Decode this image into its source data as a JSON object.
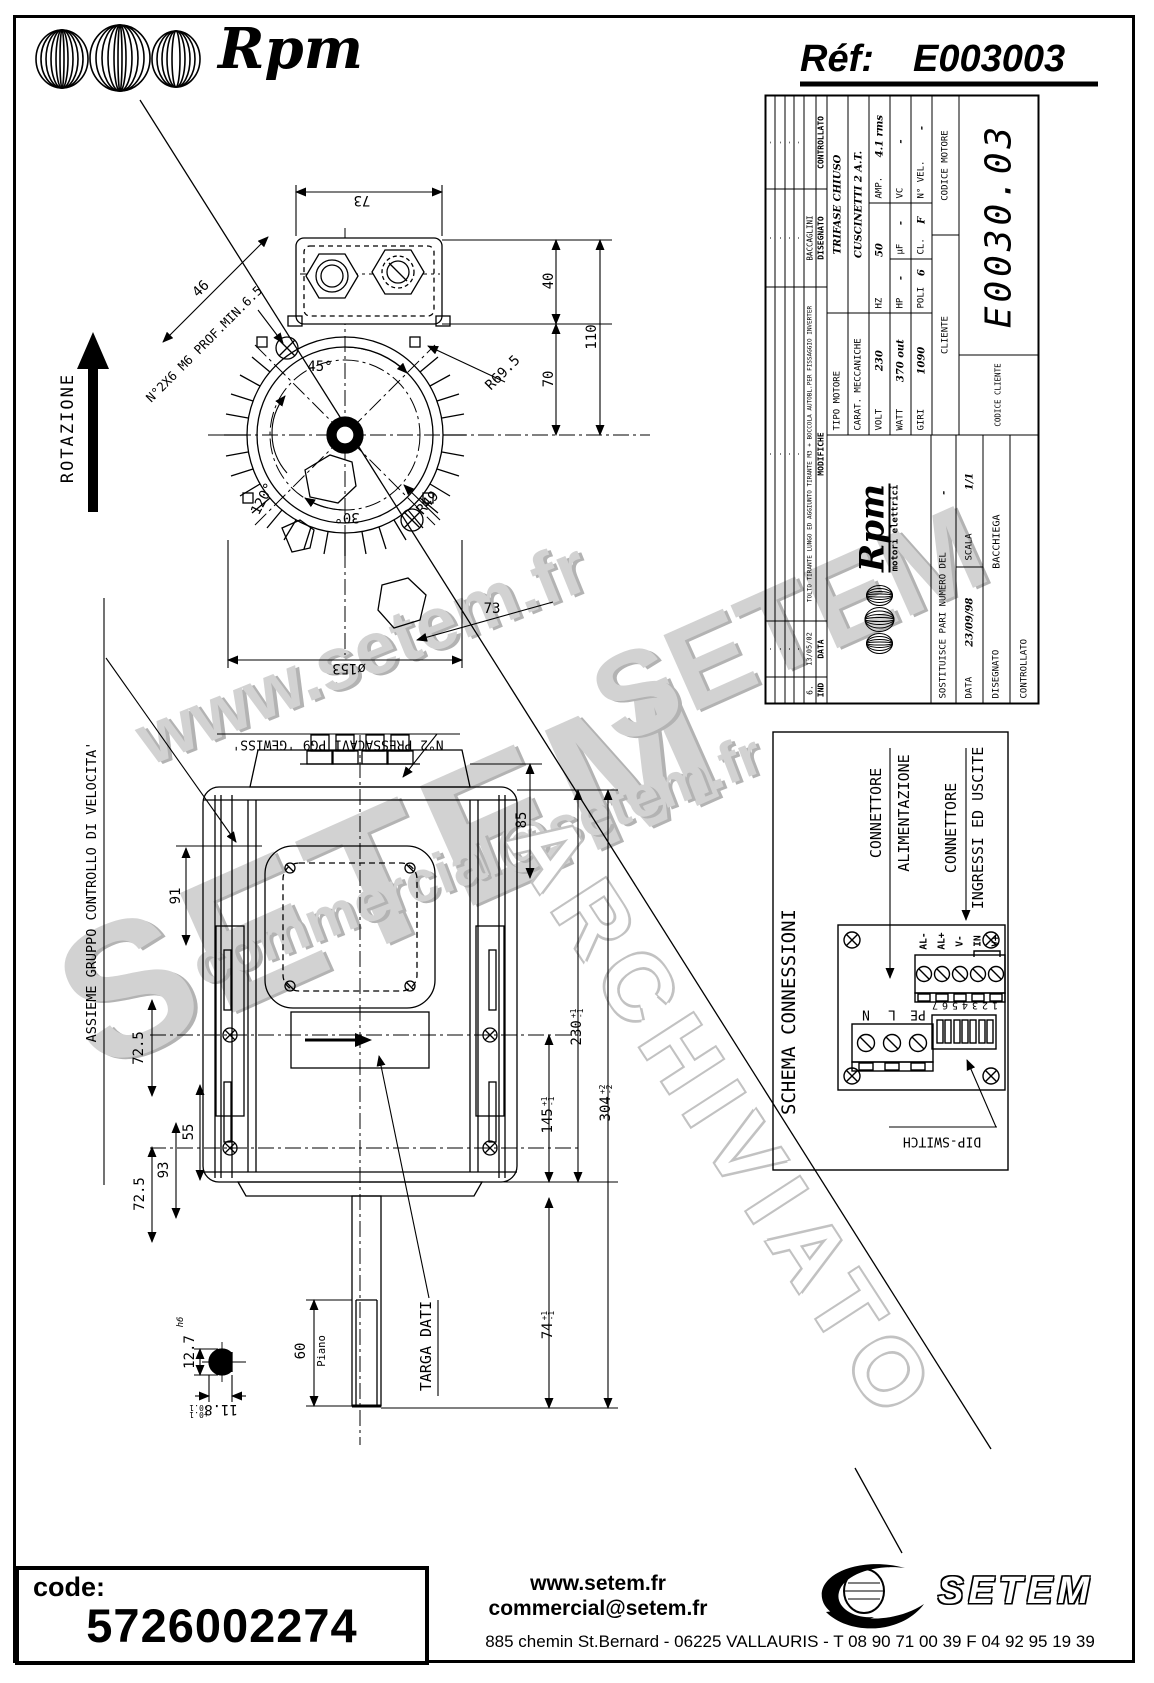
{
  "header": {
    "brand": "Rpm",
    "ref_label": "Réf:",
    "ref_value": "E003003"
  },
  "end_view": {
    "rotation_label": "ROTAZIONE",
    "dim_width_top": "73",
    "dim_40": "40",
    "dim_70": "70",
    "dim_110": "110",
    "dim_46": "46",
    "hole_note": "N°2X6 M6 PROF.MIN.6.5",
    "angle_45": "45°",
    "angle_120": "120°",
    "angle_30": "30°",
    "radius_r695": "R69.5",
    "radius_r49": "R49",
    "dim_73_bottom": "73",
    "diameter": "ø153"
  },
  "side_view": {
    "label_assieme": "ASSIEME GRUPPO CONTROLLO DI VELOCITA'",
    "label_pressacavi": "N°2 PRESSACAVI PG9 'GEWISS'",
    "dim_91": "91",
    "dim_72_5_a": "72.5",
    "dim_55": "55",
    "dim_93": "93",
    "dim_72_5_b": "72.5",
    "dim_85": "85",
    "dim_230": {
      "v": "230",
      "tp": "+1",
      "tm": "-1"
    },
    "dim_145": {
      "v": "145",
      "tp": "+1",
      "tm": "-1"
    },
    "dim_304": {
      "v": "304",
      "tp": "+2",
      "tm": "-2"
    },
    "dim_74": {
      "v": "74",
      "tp": "+1",
      "tm": "-1"
    },
    "dim_60": "60",
    "label_piano": "Piano",
    "label_targa": "TARGA DATI",
    "dim_12_7": "12.7",
    "tol_h6": "h6",
    "dim_11_8": "11.8",
    "tol_11_8_p": "+0.1",
    "tol_11_8_m": "-0.1"
  },
  "schema": {
    "title": "SCHEMA CONNESSIONI",
    "conn_alim_line1": "CONNETTORE",
    "conn_alim_line2": "ALIMENTAZIONE",
    "conn_io_line1": "CONNETTORE",
    "conn_io_line2": "INGRESSI ED USCITE",
    "io_labels": [
      "AL-",
      "AL+",
      "V-",
      "IN",
      "V+"
    ],
    "power_labels": [
      "PE",
      "L",
      "N"
    ],
    "dip_numbers": "1234567",
    "dip_label": "DIP-SWITCH"
  },
  "title_block": {
    "mod_headers": {
      "ind": "IND",
      "data": "DATA",
      "modifiche": "MODIFICHE",
      "disegnato": "DISEGNATO",
      "controllato": "CONTROLLATO"
    },
    "mod_rows": [
      {
        "ind": "",
        "date": "-",
        "text": "-",
        "dis": "-",
        "ctrl": "-"
      },
      {
        "ind": "",
        "date": "-",
        "text": "-",
        "dis": "-",
        "ctrl": "-"
      },
      {
        "ind": "",
        "date": "-",
        "text": "-",
        "dis": "-",
        "ctrl": "-"
      },
      {
        "ind": "",
        "date": "-",
        "text": "-",
        "dis": "-",
        "ctrl": "-"
      },
      {
        "ind": "6.",
        "date": "13/05/02",
        "text": "TOLTO TIRANTE LUNGO ED AGGIUNTO TIRANTE M3 + BOCCOLA AUTOBL.PER FISSAGGIO INVERTER",
        "dis": "BACCAGLINI",
        "ctrl": ""
      }
    ],
    "logo": {
      "brand": "Rpm",
      "sub": "motori elettrici"
    },
    "tipo_motore_label": "TIPO MOTORE",
    "tipo_motore_value": "TRIFASE CHIUSO",
    "carat_label": "CARAT. MECCANICHE",
    "carat_value": "CUSCINETTI 2 A.T.",
    "volt_label": "VOLT",
    "volt_value": "230",
    "hz_label": "HZ",
    "hz_value": "50",
    "amp_label": "AMP.",
    "amp_value": "4.1 rms",
    "watt_label": "WATT",
    "watt_value": "370 out",
    "hp_label": "HP",
    "hp_value": "-",
    "uf_label": "µF",
    "uf_value": "-",
    "vc_label": "VC",
    "vc_value": "-",
    "giri_label": "GIRI",
    "giri_value": "1090",
    "poli_label": "POLI",
    "poli_value": "6",
    "cl_label": "CL.",
    "cl_value": "F",
    "nvel_label": "N° VEL.",
    "nvel_value": "-",
    "cliente_label": "CLIENTE",
    "codice_motore_label": "CODICE MOTORE",
    "codice_motore_value": "E0030.03",
    "codice_cliente_label": "CODICE CLIENTE",
    "sostituisce_label": "SOSTITUISCE PARI NUMERO DEL",
    "sostituisce_value": "-",
    "data_label": "DATA",
    "data_value": "23/09/98",
    "scala_label": "SCALA",
    "scala_value": "1/1",
    "disegnato_label": "DISEGNATO",
    "disegnato_value": "BACCHIEGA",
    "controllato_label": "CONTROLLATO",
    "controllato_value": ""
  },
  "watermarks": {
    "site": "www.setem.fr",
    "brand": "SETEM",
    "email": "commercial@setem.fr",
    "brand2": "SETEM",
    "archive": "ARCHIVIATO"
  },
  "footer": {
    "code_label": "code:",
    "code_value": "5726002274",
    "site": "www.setem.fr",
    "email": "commercial@setem.fr",
    "brand": "SETEM",
    "address": "885 chemin St.Bernard  -  06225 VALLAURIS  -  T 08 90 71 00 39   F 04 92 95 19 39"
  }
}
